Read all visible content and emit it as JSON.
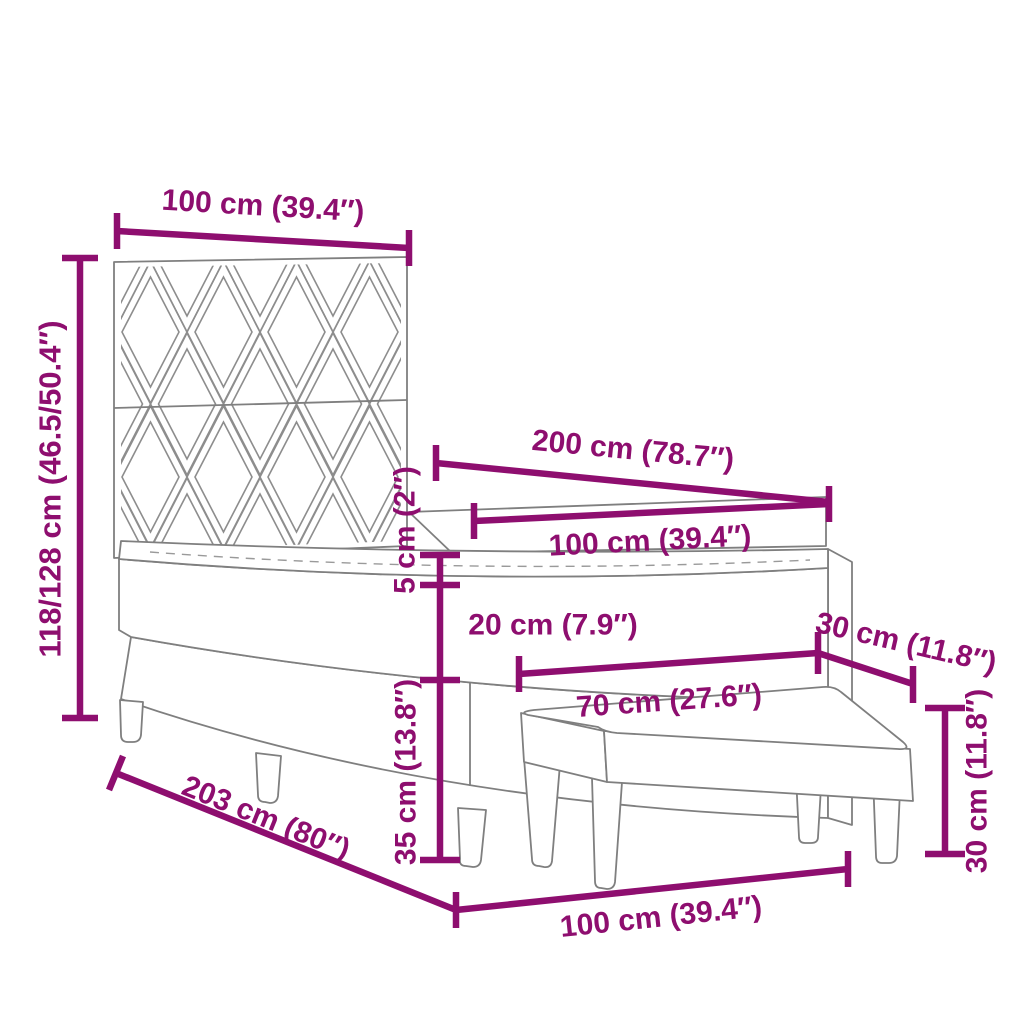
{
  "title": "Box spring bed with bench dimension diagram",
  "colors": {
    "dimension": "#8E0E6F",
    "line": "#7f7f7f",
    "pattern": "#8d8d8d",
    "stitch": "#9a9a9a",
    "background": "#ffffff"
  },
  "dims": {
    "headboard_width": "100 cm (39.4″)",
    "headboard_height": "118/128 cm (46.5/50.4″)",
    "bed_length": "200 cm (78.7″)",
    "mattress_width": "100 cm (39.4″)",
    "topper_thickness": "5 cm (2″)",
    "mattress_thickness": "20 cm (7.9″)",
    "bench_depth": "30 cm (11.8″)",
    "bench_width": "70 cm (27.6″)",
    "base_height": "35 cm (13.8″)",
    "bench_height": "30 cm (11.8″)",
    "bed_diagonal_length": "203 cm (80″)",
    "bed_width": "100 cm (39.4″)"
  }
}
